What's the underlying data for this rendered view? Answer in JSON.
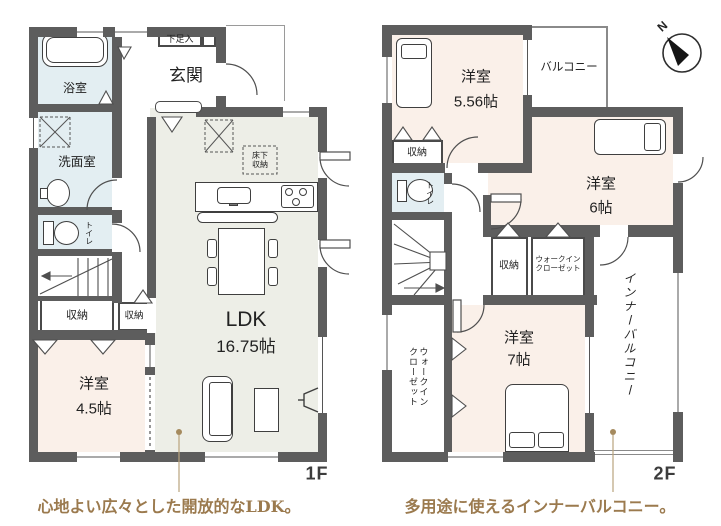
{
  "floor1": {
    "floor_label": "1F",
    "entrance": "玄関",
    "shoe_storage": "下足入",
    "bathroom": "浴室",
    "washroom": "洗面室",
    "toilet": "トイレ",
    "stair_storage": "収納",
    "hall_storage": "収納",
    "ldk_name": "LDK",
    "ldk_size": "16.75帖",
    "underfloor_storage_line1": "床下",
    "underfloor_storage_line2": "収納",
    "bedroom_name": "洋室",
    "bedroom_size": "4.5帖"
  },
  "floor2": {
    "floor_label": "2F",
    "bedroom1_name": "洋室",
    "bedroom1_size": "5.56帖",
    "balcony": "バルコニー",
    "bedroom1_closet": "収納",
    "toilet": "トイレ",
    "bedroom2_name": "洋室",
    "bedroom2_size": "6帖",
    "hall_storage": "収納",
    "wic_small_line1": "ウォークイン",
    "wic_small_line2": "クローゼット",
    "wic_large_col1": "ウォークイン",
    "wic_large_col2": "クローゼット",
    "bedroom3_name": "洋室",
    "bedroom3_size": "7帖",
    "inner_balcony": "インナーバルコニー"
  },
  "captions": {
    "ldk": "心地よい広々とした開放的なLDK。",
    "inner_balcony": "多用途に使えるインナーバルコニー。"
  },
  "compass_label": "N",
  "colors": {
    "wall": "#5d5d5d",
    "room_pink": "#faf0e9",
    "room_blue": "#e3eef2",
    "room_ldk": "#edeee7",
    "caption_brown": "#9b7a4e",
    "leader_line": "#b9a37d"
  }
}
